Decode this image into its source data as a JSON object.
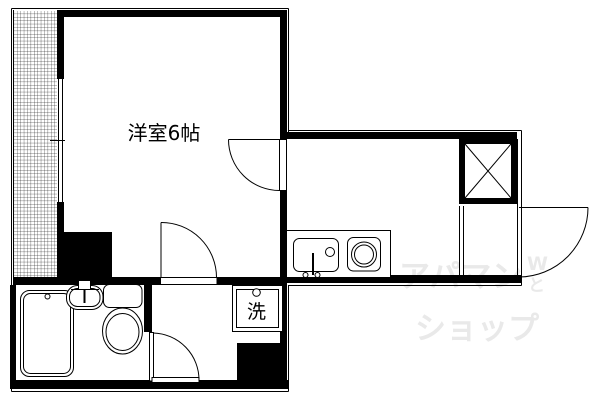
{
  "floorplan": {
    "main_room_label": "洋室6帖",
    "laundry_label": "洗"
  },
  "watermark": {
    "line1": "アパマン",
    "line2": "ショップ",
    "mark_top": "W",
    "mark_bottom": "と",
    "color": "#e9e9e9"
  },
  "colors": {
    "line": "#000000",
    "background": "#ffffff"
  }
}
